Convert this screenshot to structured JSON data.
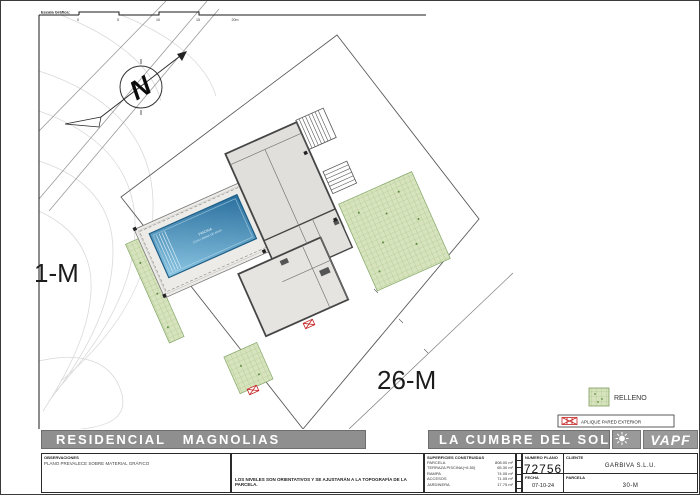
{
  "plan": {
    "scale": {
      "label": "Escala Gráfica:",
      "ticks": [
        "0",
        "5",
        "10",
        "15",
        "20m"
      ]
    },
    "north_letter": "N",
    "labels": {
      "parcel_left": "1-M",
      "parcel_bottom": "26-M"
    },
    "pool": {
      "line1": "PISCINA",
      "line2": "COTA LÁMINA DE AGUA"
    },
    "legend": {
      "relleno": "RELLENO",
      "aplique": "APLIQUE PARED EXTERIOR"
    }
  },
  "titlebar": {
    "project": "RESIDENCIAL   MAGNOLIAS",
    "location": "LA CUMBRE DEL SOL",
    "brand": "VAPF"
  },
  "info": {
    "observaciones_label": "OBSERVACIONES",
    "observaciones_text": "PLANO PREVALECE SOBRE MATERIAL GRÁFICO",
    "note": "LOS NIVELES SON ORIENTATIVOS Y SE AJUSTARÁN A LA TOPOGRAFÍA DE LA PARCELA.",
    "superficies_title": "SUPERFICIES CONSTRUIDAS",
    "superficies_rows": [
      {
        "name": "PARCELA",
        "value": "808.00 m²"
      },
      {
        "name": "TERRAZA PISCINA(+6.50)",
        "value": "65.30 m²"
      },
      {
        "name": "RAMPA",
        "value": "74.05 m²"
      },
      {
        "name": "ACCESOS",
        "value": "71.05 m²"
      },
      {
        "name": "JARDINERA",
        "value": "17.75 m²"
      }
    ],
    "numero_plano_label": "NUMERO PLANO",
    "numero_plano": "72756",
    "cliente_label": "CLIENTE",
    "cliente": "GARBIVA S.L.U.",
    "fecha_label": "FECHA",
    "fecha": "07-10-24",
    "parcela_label": "PARCELA",
    "parcela": "30-M"
  },
  "colors": {
    "band_gray": "#8f8f8f",
    "pool_blue": "#4d9ec9",
    "relleno_green": "#d6e3bd",
    "aplique_red": "#c42222"
  }
}
